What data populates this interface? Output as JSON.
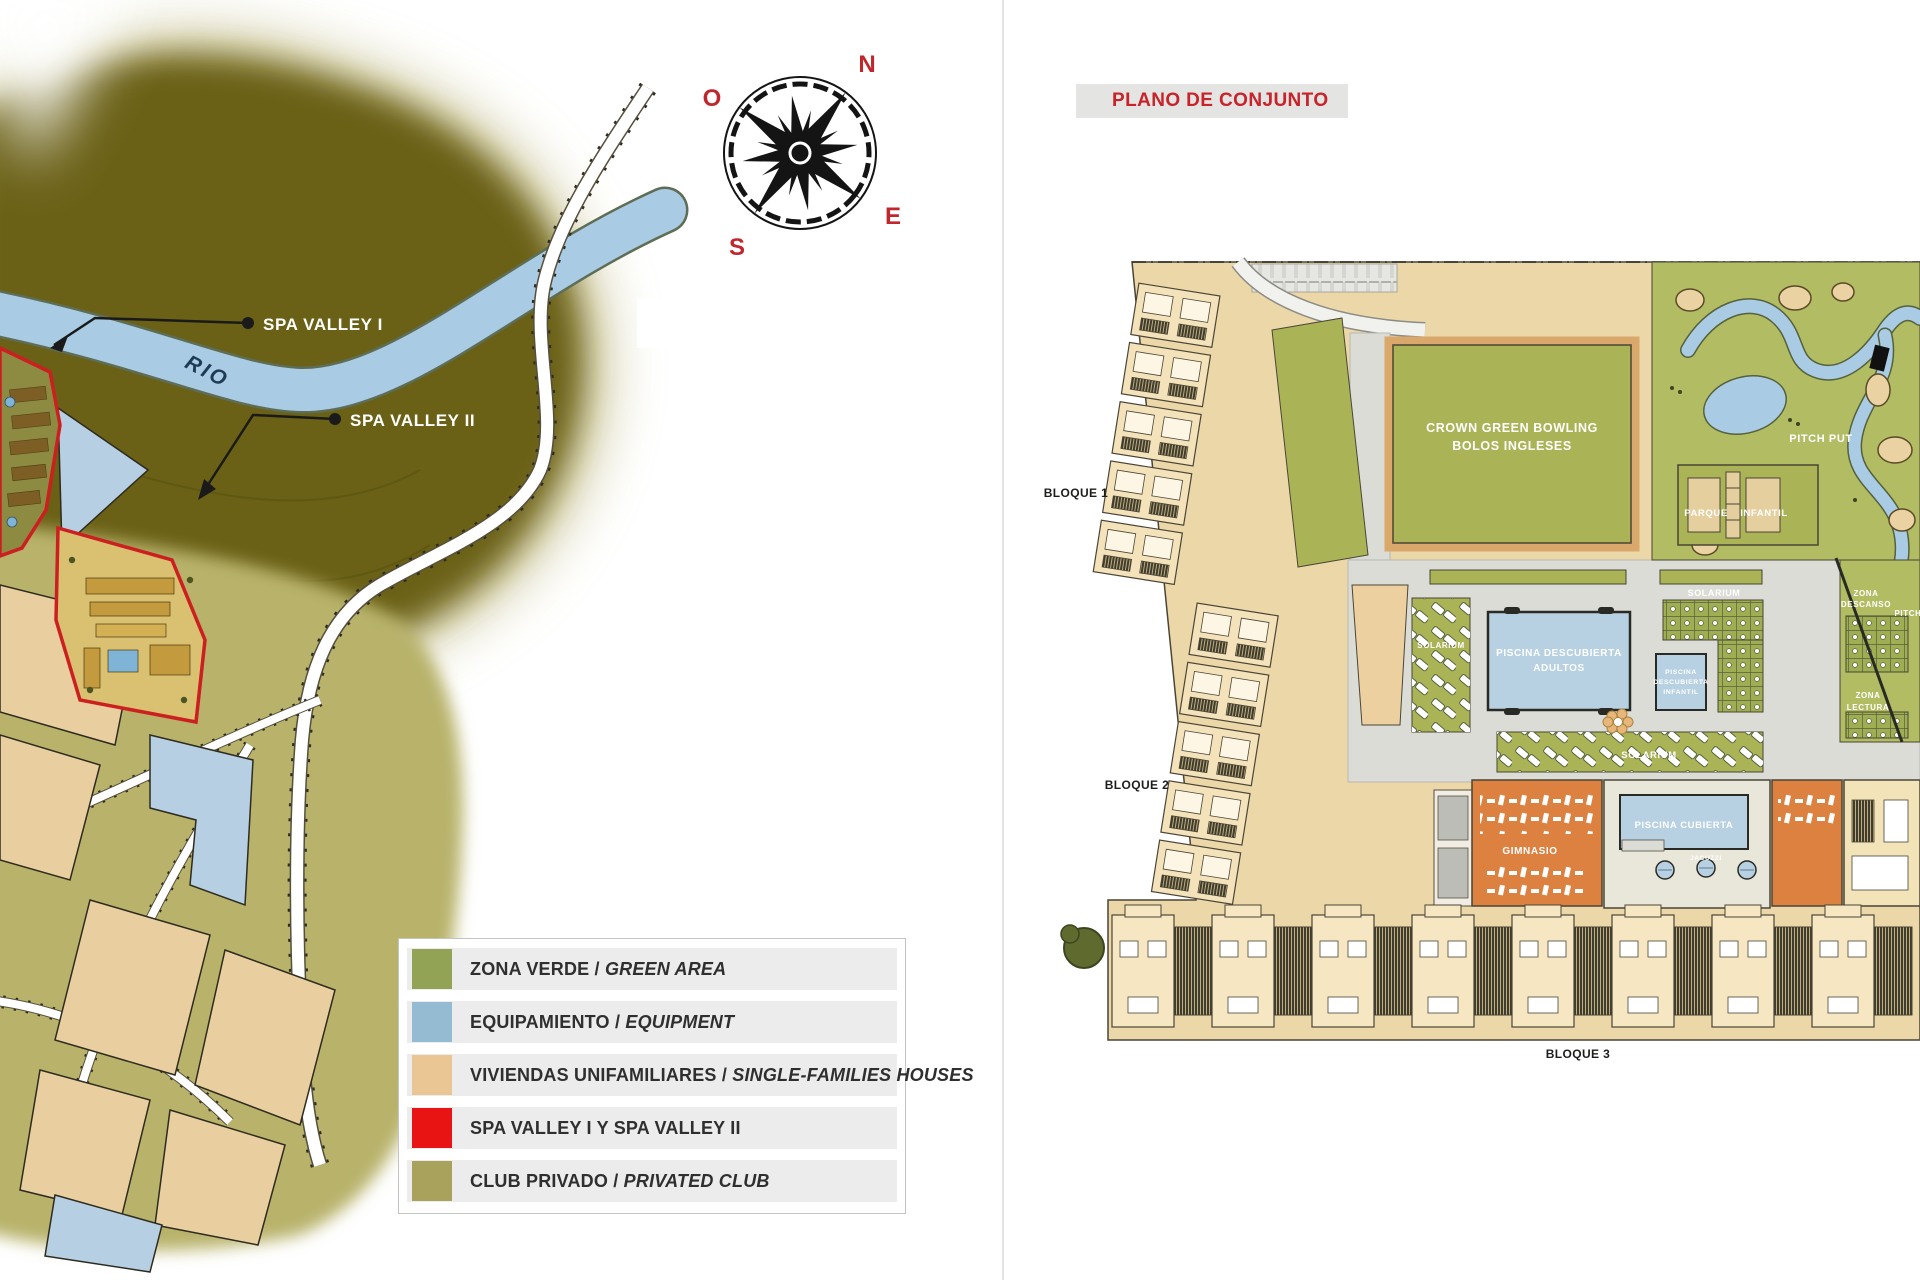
{
  "left": {
    "compass": {
      "n": "N",
      "o": "O",
      "e": "E",
      "s": "S"
    },
    "river_label": "RIO",
    "callouts": [
      {
        "label": "SPA VALLEY I"
      },
      {
        "label": "SPA VALLEY II"
      }
    ],
    "legend": {
      "items": [
        {
          "es": "ZONA VERDE / ",
          "en": "GREEN AREA",
          "color": "#93a355"
        },
        {
          "es": "EQUIPAMIENTO / ",
          "en": "EQUIPMENT",
          "color": "#94bbd2"
        },
        {
          "es": "VIVIENDAS UNIFAMILIARES / ",
          "en": "SINGLE-FAMILIES HOUSES",
          "color": "#eac694"
        },
        {
          "es": "SPA VALLEY I Y SPA VALLEY II",
          "en": "",
          "color": "#e81414"
        },
        {
          "es": "CLUB PRIVADO / ",
          "en": "PRIVATED CLUB",
          "color": "#a8a25c"
        }
      ]
    }
  },
  "right": {
    "title": "PLANO DE CONJUNTO",
    "plan": {
      "bloque1": "BLOQUE 1",
      "bloque2": "BLOQUE 2",
      "bloque3": "BLOQUE 3",
      "bowling_1": "CROWN GREEN BOWLING",
      "bowling_2": "BOLOS INGLESES",
      "pitch_put": "PITCH PUT",
      "pitch_partial": "PITCH",
      "parque_1": "PARQUE",
      "parque_2": "INFANTIL",
      "solarium": "SOLARIUM",
      "pool_adults_1": "PISCINA DESCUBIERTA",
      "pool_adults_2": "ADULTOS",
      "pool_infant_1": "PISCINA",
      "pool_infant_2": "DESCUBIERTA",
      "pool_infant_3": "INFANTIL",
      "zona_descanso_1": "ZONA",
      "zona_descanso_2": "DESCANSO",
      "zona_lectura_1": "ZONA",
      "zona_lectura_2": "LECTURA",
      "gimnasio": "GIMNASIO",
      "piscina_cubierta": "PISCINA CUBIERTA",
      "jacuzzi": "JACUZZI"
    }
  },
  "colors": {
    "accent_red": "#c8232a",
    "map_dark_olive": "#6b6116",
    "map_light_olive": "#b8b26a",
    "river_blue": "#a9cce4",
    "plan_ground": "#ecd7a8",
    "plan_green": "#aab457",
    "pool_blue": "#b7d1e3",
    "building_orange": "#dc8140",
    "paving_gray": "#dcdcd6"
  }
}
